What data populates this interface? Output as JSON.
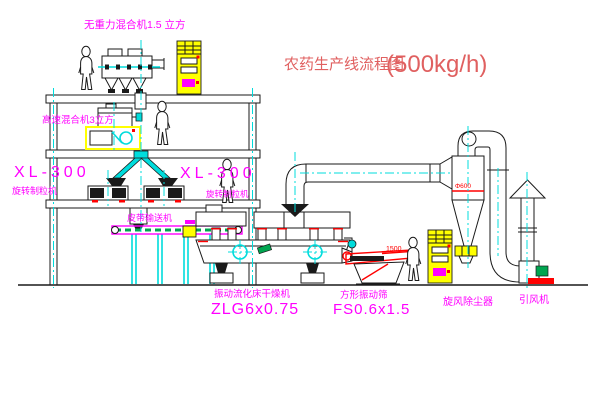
{
  "title": {
    "text": "农药生产线流程图",
    "capacity": "(500kg/h)"
  },
  "equipment": {
    "gravity_mixer": {
      "label": "无重力混合机1.5 立方"
    },
    "high_speed_mixer": {
      "label": "高速混合机3立方"
    },
    "granulator_left": {
      "model": "XL-300",
      "name": "旋转制粒机"
    },
    "granulator_right": {
      "model": "XL-300",
      "name": "旋转制粒机"
    },
    "belt_conveyor": {
      "label": "皮带输送机"
    },
    "fluid_bed_dryer": {
      "name": "振动流化床干燥机",
      "model": "ZLG6x0.75"
    },
    "square_sieve": {
      "name": "方形振动筛",
      "model": "FS0.6x1.5",
      "dimension": "1500"
    },
    "cyclone": {
      "label": "旋风除尘器",
      "dimension": "Φ600"
    },
    "induced_draft_fan": {
      "label": "引风机"
    }
  },
  "colors": {
    "magenta": "#ff00ff",
    "red": "#ff0000",
    "title_red": "#e06060",
    "cyan": "#00dcdc",
    "yellow": "#ffff00",
    "green": "#00a550"
  }
}
